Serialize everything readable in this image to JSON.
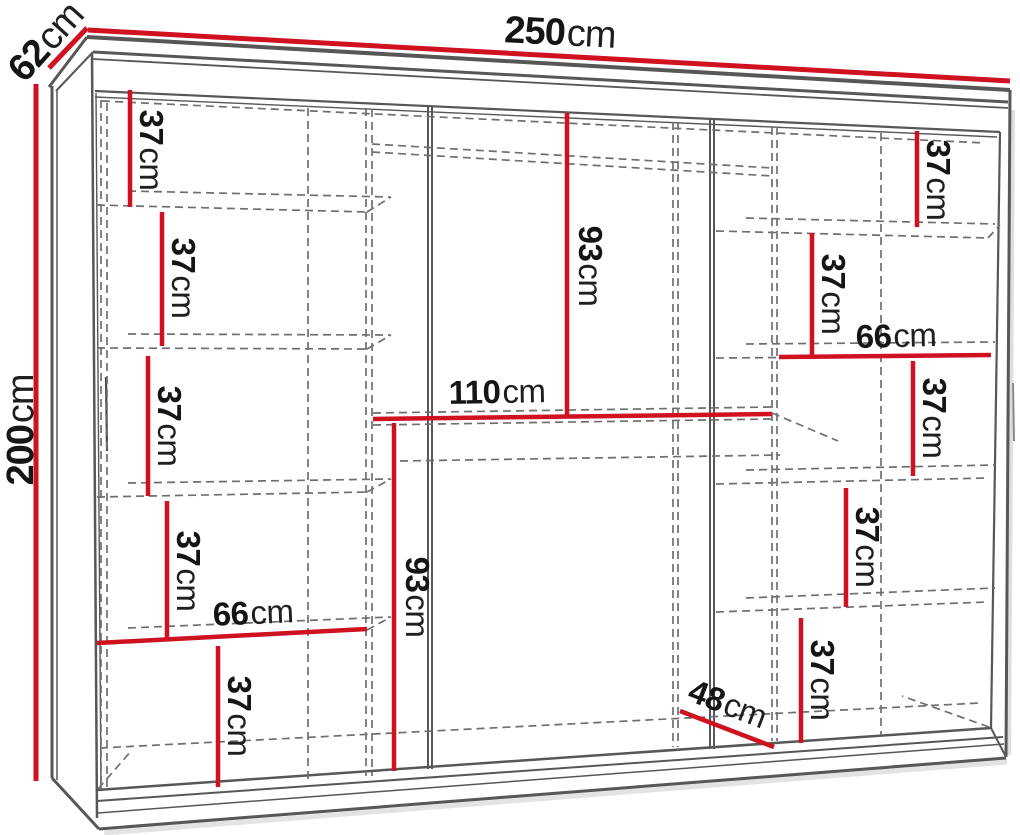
{
  "diagram": {
    "kind": "wardrobe dimension drawing",
    "unit": "cm"
  },
  "dims": {
    "width_top": {
      "value": "250",
      "unit": "cm"
    },
    "depth_top_left": {
      "value": "62",
      "unit": "cm"
    },
    "height_left": {
      "value": "200",
      "unit": "cm"
    },
    "left_gap_1": {
      "value": "37",
      "unit": "cm"
    },
    "left_gap_2": {
      "value": "37",
      "unit": "cm"
    },
    "left_gap_3": {
      "value": "37",
      "unit": "cm"
    },
    "left_gap_4": {
      "value": "37",
      "unit": "cm"
    },
    "left_width": {
      "value": "66",
      "unit": "cm"
    },
    "left_gap_5": {
      "value": "37",
      "unit": "cm"
    },
    "mid_upper_height": {
      "value": "93",
      "unit": "cm"
    },
    "mid_width": {
      "value": "110",
      "unit": "cm"
    },
    "mid_lower_height": {
      "value": "93",
      "unit": "cm"
    },
    "right_gap_1": {
      "value": "37",
      "unit": "cm"
    },
    "right_gap_2": {
      "value": "37",
      "unit": "cm"
    },
    "right_width": {
      "value": "66",
      "unit": "cm"
    },
    "right_gap_3": {
      "value": "37",
      "unit": "cm"
    },
    "right_gap_4": {
      "value": "37",
      "unit": "cm"
    },
    "right_gap_5": {
      "value": "37",
      "unit": "cm"
    },
    "bottom_niche": {
      "value": "48",
      "unit": "cm"
    }
  },
  "colors": {
    "dimension_line": "#cf1120",
    "outline": "#575757",
    "dashed_guide": "#6f6f6f",
    "label_text": "#151515",
    "background": "#ffffff"
  }
}
